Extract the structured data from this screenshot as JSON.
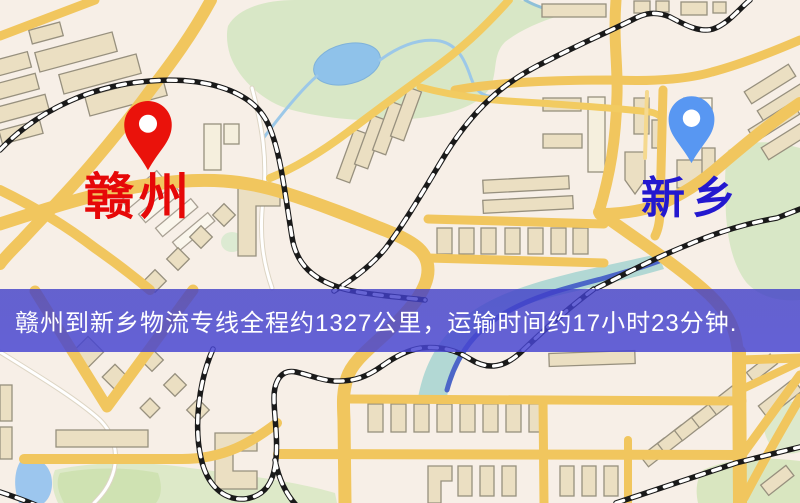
{
  "banner": {
    "text": "赣州到新乡物流专线全程约1327公里，运输时间约17小时23分钟.",
    "background_color": "#403EC8",
    "text_color": "#FFFFFF"
  },
  "markers": {
    "origin": {
      "label": "赣州",
      "pin_color": "#EA120B",
      "label_color": "#E60808"
    },
    "destination": {
      "label": "新乡",
      "pin_color": "#5897F2",
      "label_color": "#2318CF"
    }
  },
  "map": {
    "background_color": "#F7EFE7",
    "road_color": "#F1C65E",
    "minor_road_color": "#F5D98F",
    "park_color": "#D8E7C6",
    "water_color": "#9CC6EE",
    "river_color": "#4C66C8",
    "building_color": "#EBDFC2",
    "railway_color": "#1A1A1A"
  }
}
